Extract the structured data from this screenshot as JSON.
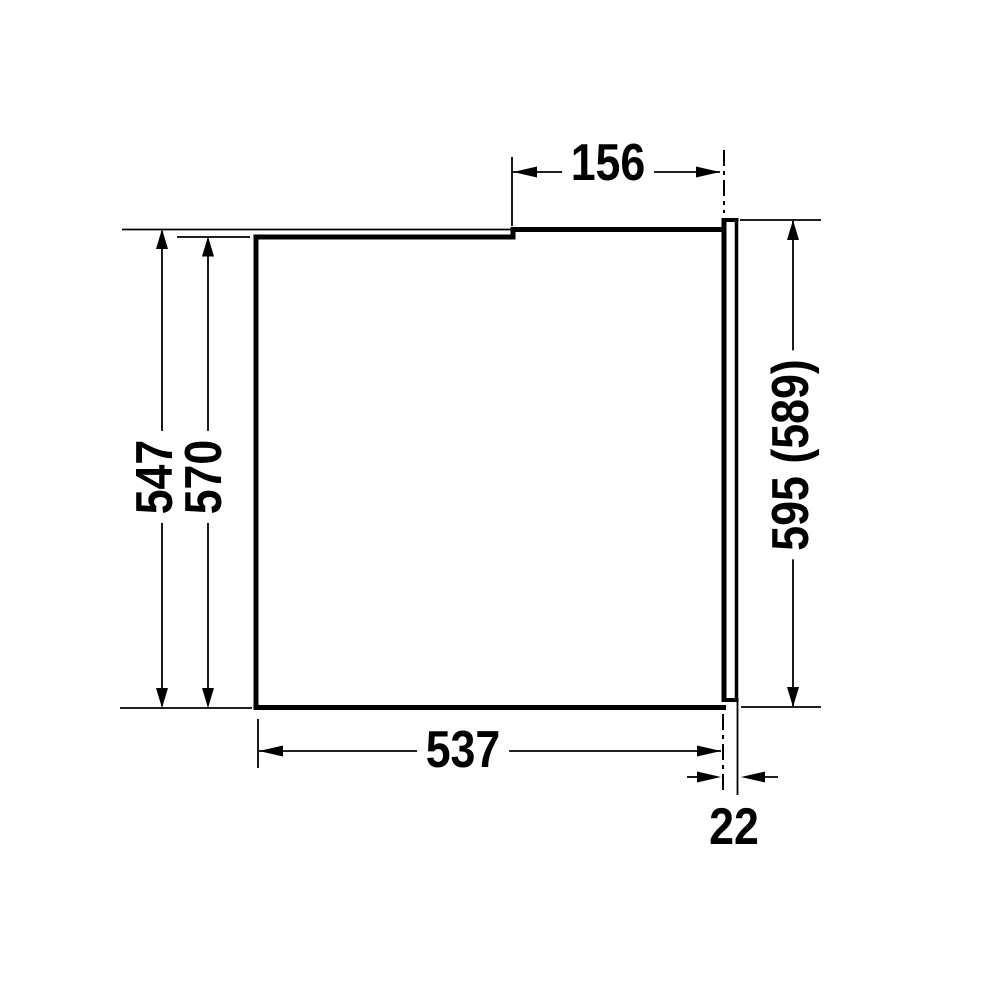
{
  "dims": {
    "top": "156",
    "left_outer": "547",
    "left_inner": "570",
    "right": "595 (589)",
    "bottom": "537",
    "door": "22"
  },
  "colors": {
    "line": "#000000",
    "background": "#ffffff"
  }
}
